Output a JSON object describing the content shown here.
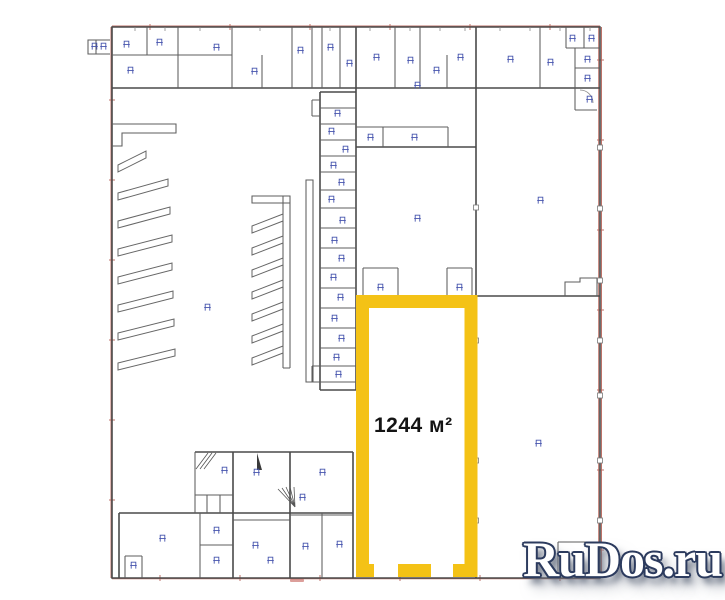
{
  "plan": {
    "highlight": {
      "area_label": "1244 м²",
      "color": "#F4C216"
    },
    "colors": {
      "wall": "#4a4a4a",
      "survey_red_line": "#b96a60",
      "fixture_blue": "#4553ad",
      "area_label_text": "#141414"
    }
  },
  "watermark": {
    "text": "RuDos.ru",
    "fill": "#ffffff",
    "outline": "#2c3b5e"
  }
}
